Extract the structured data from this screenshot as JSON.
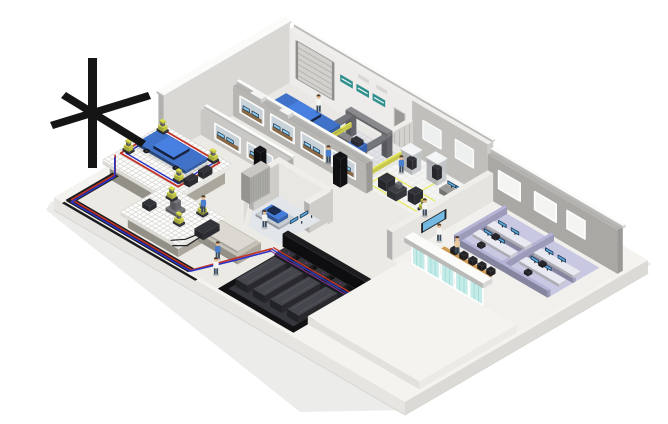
{
  "scene": {
    "type": "isometric-3d-illustration",
    "subject": "Cutaway 3D rendering of an automotive test facility on a white base slab",
    "background": "#ffffff",
    "areas": [
      {
        "id": "garage",
        "label": "Vehicle garage with blue car, roller shutter door and gantry test rig"
      },
      {
        "id": "test-lab",
        "label": "Test lab with load-frame rigs, bench monitors and yellow floor markings"
      },
      {
        "id": "control-rooms",
        "label": "Rows of control rooms with window walls, desks and blue monitors"
      },
      {
        "id": "test-hall",
        "label": "Test hall with two seismic-block platforms, blue car and yellow robots"
      },
      {
        "id": "test-cell",
        "label": "White test cell with blue test unit and monitors, shaker table in front"
      },
      {
        "id": "dyno-room",
        "label": "Dark basement room with dynamometer units"
      },
      {
        "id": "office",
        "label": "Open-plan office with lavender cubicles, monitors and conference table"
      },
      {
        "id": "entrance",
        "label": "Teal glass curtain-wall entrance on a white wing"
      }
    ],
    "objects": {
      "blue_cars": 2,
      "seismic_block_platforms": 2,
      "yellow_robot_units": 8,
      "dyno_units": 4,
      "control_room_windows": 6,
      "roller_door_signs": 3,
      "conference_chairs": 10,
      "office_monitors": 8,
      "glass_entrance_panels": 5,
      "people": 10,
      "speaker_towers": 2,
      "wall_tv": 1
    },
    "palette": {
      "bg": "#ffffff",
      "slabTop": "#f4f3f0",
      "slabSide": "#e7e5e1",
      "wallWhite": "#efeeeb",
      "wallLight": "#e2e0dc",
      "wallGray": "#b3b2ae",
      "wallCap": "#fbfbf9",
      "floorLight": "#eceae5",
      "floorTile": "#f4f4f2",
      "black": "#1b1b1d",
      "basementFloor": "#36373c",
      "concrete": "#c7c2b6",
      "gridTop": "#fdfdfc",
      "gridLine": "#d6d5d1",
      "carBlue": "#3f72c8",
      "carGlass": "#1c2c4e",
      "robotYellow": "#dde04e",
      "fenceYellow": "#e8ea58",
      "machineGray": "#75767c",
      "machineDark": "#33343a",
      "pipeRed": "#c23327",
      "pipeBlue": "#2a35c4",
      "pipePurple": "#7c2e8e",
      "screenBlue": "#5da9d9",
      "screenLight": "#8ccbec",
      "lavFloor": "#c9c8e3",
      "lavWall": "#b5b4d7",
      "deskWhite": "#e9e9f2",
      "wood": "#c08a45",
      "chairBlack": "#26262a",
      "glassTeal": "#c4ebe7",
      "tealSign": "#2f8f8d",
      "skin": "#e9bd92",
      "shirtBlue": "#4a7fd0",
      "pants": "#3a4a5e"
    }
  }
}
